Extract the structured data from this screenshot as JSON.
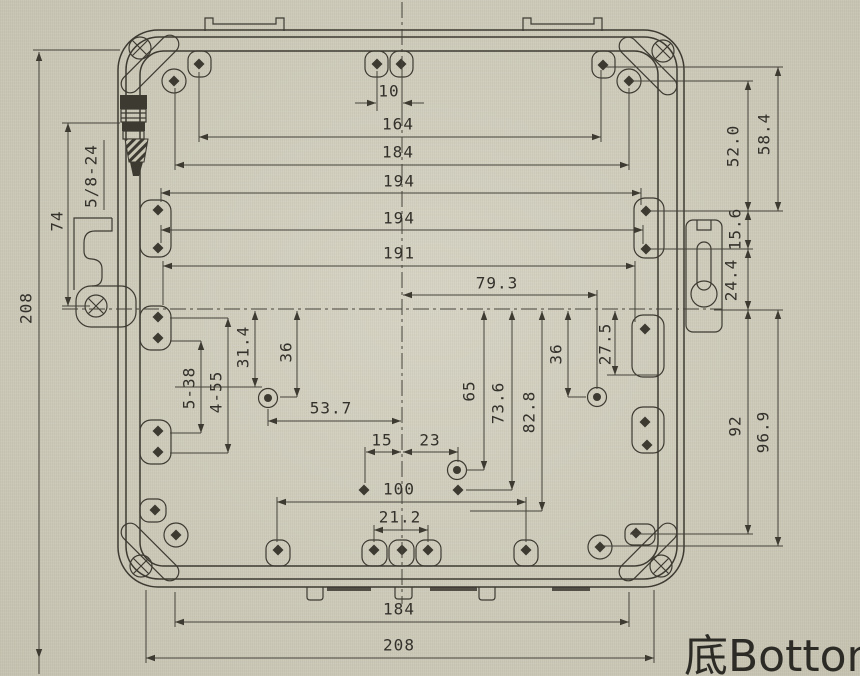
{
  "drawing": {
    "view_label": "底Botton",
    "thread_callout": "5/8-24",
    "hole_callouts": [
      "5-38",
      "4-55"
    ],
    "colors": {
      "paper": "#d2cfbe",
      "ink": "#3d3a32"
    },
    "dimensions": {
      "top_horizontal": [
        "10",
        "164",
        "184",
        "194",
        "194",
        "191",
        "79.3"
      ],
      "mid_horizontal": [
        "53.7",
        "15",
        "23",
        "100",
        "21.2"
      ],
      "bottom_horizontal": [
        "184",
        "208"
      ],
      "left_vertical": [
        "208",
        "74"
      ],
      "interior_vertical": [
        "31.4",
        "36",
        "65",
        "73.6",
        "82.8",
        "36",
        "27.5"
      ],
      "right_vertical": [
        "52.0",
        "58.4",
        "15.6",
        "24.4",
        "92",
        "96.9"
      ]
    },
    "labels": [
      {
        "text": "10",
        "x": 389,
        "y": 91,
        "rot": false
      },
      {
        "text": "164",
        "x": 398,
        "y": 124,
        "rot": false
      },
      {
        "text": "184",
        "x": 398,
        "y": 152,
        "rot": false
      },
      {
        "text": "194",
        "x": 399,
        "y": 181,
        "rot": false
      },
      {
        "text": "194",
        "x": 399,
        "y": 218,
        "rot": false
      },
      {
        "text": "191",
        "x": 399,
        "y": 253,
        "rot": false
      },
      {
        "text": "79.3",
        "x": 497,
        "y": 283,
        "rot": false
      },
      {
        "text": "53.7",
        "x": 331,
        "y": 408,
        "rot": false
      },
      {
        "text": "15",
        "x": 382,
        "y": 440,
        "rot": false
      },
      {
        "text": "23",
        "x": 430,
        "y": 440,
        "rot": false
      },
      {
        "text": "100",
        "x": 399,
        "y": 489,
        "rot": false
      },
      {
        "text": "21.2",
        "x": 400,
        "y": 517,
        "rot": false
      },
      {
        "text": "184",
        "x": 399,
        "y": 609,
        "rot": false
      },
      {
        "text": "208",
        "x": 399,
        "y": 645,
        "rot": false
      },
      {
        "text": "208",
        "x": 26,
        "y": 308,
        "rot": true
      },
      {
        "text": "74",
        "x": 57,
        "y": 221,
        "rot": true
      },
      {
        "text": "5/8-24",
        "x": 91,
        "y": 176,
        "rot": true
      },
      {
        "text": "5-38",
        "x": 189,
        "y": 388,
        "rot": true
      },
      {
        "text": "4-55",
        "x": 216,
        "y": 392,
        "rot": true
      },
      {
        "text": "31.4",
        "x": 243,
        "y": 347,
        "rot": true
      },
      {
        "text": "36",
        "x": 286,
        "y": 352,
        "rot": true
      },
      {
        "text": "65",
        "x": 469,
        "y": 391,
        "rot": true
      },
      {
        "text": "73.6",
        "x": 498,
        "y": 403,
        "rot": true
      },
      {
        "text": "82.8",
        "x": 529,
        "y": 412,
        "rot": true
      },
      {
        "text": "36",
        "x": 556,
        "y": 354,
        "rot": true
      },
      {
        "text": "27.5",
        "x": 605,
        "y": 344,
        "rot": true
      },
      {
        "text": "52.0",
        "x": 733,
        "y": 146,
        "rot": true
      },
      {
        "text": "58.4",
        "x": 764,
        "y": 134,
        "rot": true
      },
      {
        "text": "15.6",
        "x": 735,
        "y": 229,
        "rot": true
      },
      {
        "text": "24.4",
        "x": 731,
        "y": 280,
        "rot": true
      },
      {
        "text": "92",
        "x": 735,
        "y": 426,
        "rot": true
      },
      {
        "text": "96.9",
        "x": 763,
        "y": 432,
        "rot": true
      }
    ]
  }
}
